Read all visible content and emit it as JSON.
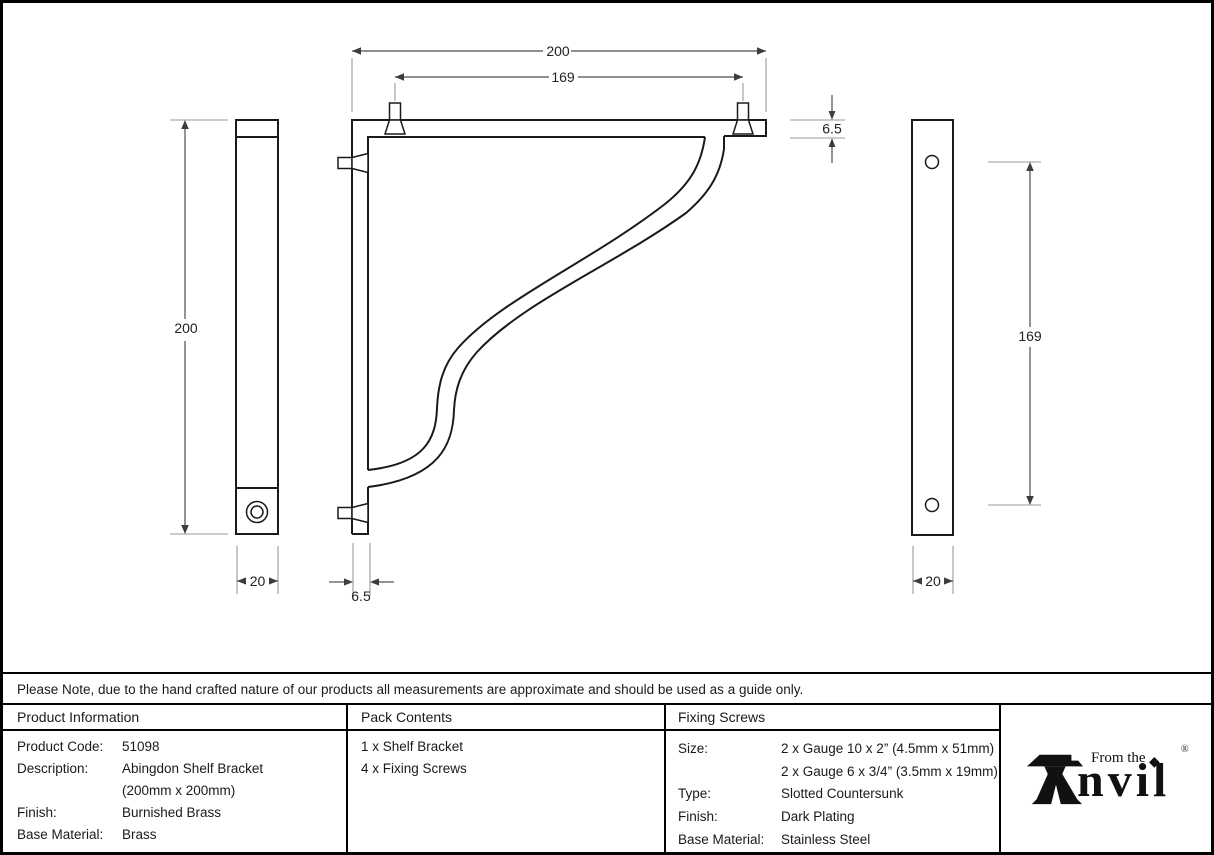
{
  "drawing": {
    "dims": {
      "top_width": "200",
      "top_holes": "169",
      "arm_thickness": "6.5",
      "height": "200",
      "left_depth": "20",
      "upright_thickness": "6.5",
      "right_holes": "169",
      "right_depth": "20"
    }
  },
  "note": {
    "text": "Please Note, due to the hand crafted nature of our products all measurements are approximate and should be used as a guide only."
  },
  "product_info": {
    "title": "Product Information",
    "rows": [
      {
        "label": "Product Code:",
        "value": "51098"
      },
      {
        "label": "Description:",
        "value": "Abingdon Shelf Bracket"
      },
      {
        "label": "",
        "value": "(200mm x 200mm)"
      },
      {
        "label": "Finish:",
        "value": "Burnished Brass"
      },
      {
        "label": "Base Material:",
        "value": "Brass"
      }
    ]
  },
  "pack_contents": {
    "title": "Pack Contents",
    "items": [
      "1 x Shelf Bracket",
      "4 x Fixing Screws"
    ]
  },
  "fixing_screws": {
    "title": "Fixing Screws",
    "rows": [
      {
        "label": "Size:",
        "value": "2 x Gauge 10 x 2” (4.5mm x 51mm)"
      },
      {
        "label": "",
        "value": "2 x Gauge 6 x 3/4” (3.5mm x 19mm)"
      },
      {
        "label": "Type:",
        "value": "Slotted Countersunk"
      },
      {
        "label": "Finish:",
        "value": "Dark Plating"
      },
      {
        "label": "Base Material:",
        "value": "Stainless Steel"
      }
    ]
  },
  "logo": {
    "prefix": "From the",
    "name_suffix": "nvil",
    "diamond": "◆",
    "registered": "®"
  }
}
